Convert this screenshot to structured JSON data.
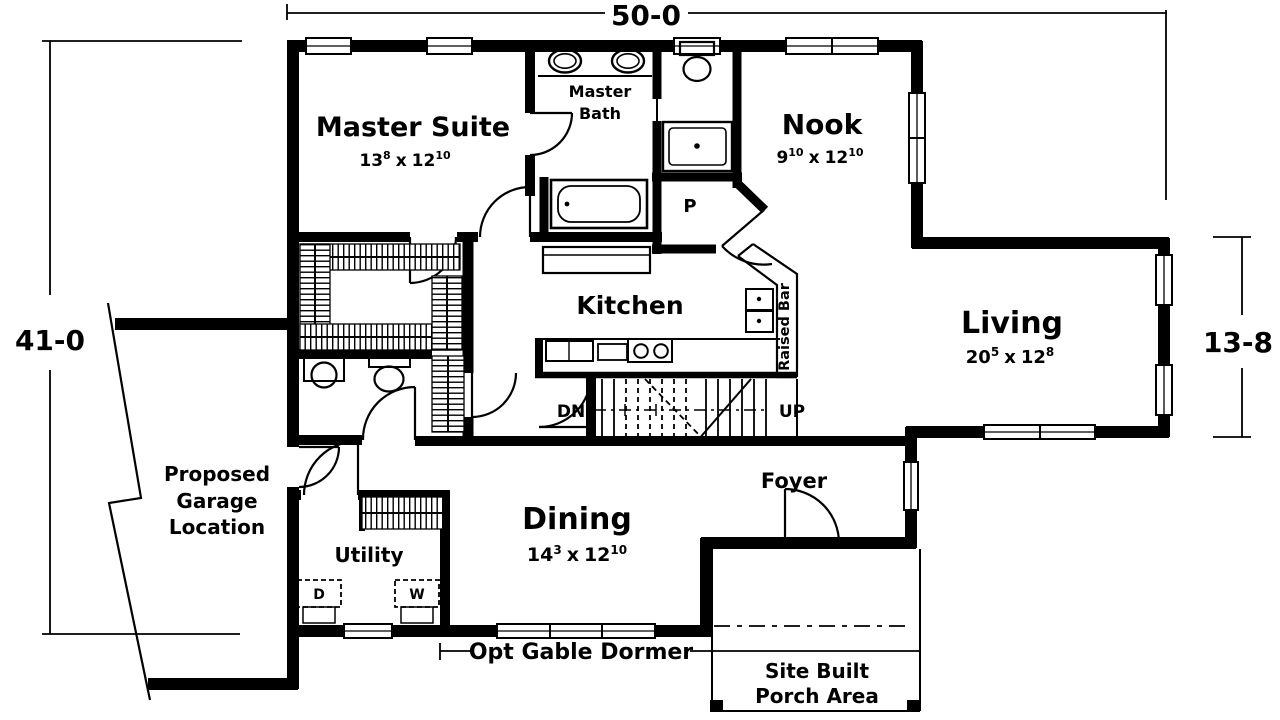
{
  "dimensions": {
    "top": "50-0",
    "left": "41-0",
    "right": "13-8"
  },
  "sep": "x",
  "rooms": {
    "master_suite": {
      "name": "Master Suite",
      "w": "13",
      "w_sup": "8",
      "h": "12",
      "h_sup": "10"
    },
    "master_bath": {
      "line1": "Master",
      "line2": "Bath"
    },
    "nook": {
      "name": "Nook",
      "w": "9",
      "w_sup": "10",
      "h": "12",
      "h_sup": "10"
    },
    "kitchen": {
      "name": "Kitchen"
    },
    "living": {
      "name": "Living",
      "w": "20",
      "w_sup": "5",
      "h": "12",
      "h_sup": "8"
    },
    "dining": {
      "name": "Dining",
      "w": "14",
      "w_sup": "3",
      "h": "12",
      "h_sup": "10"
    },
    "utility": {
      "name": "Utility"
    },
    "foyer": {
      "name": "Foyer"
    },
    "pantry": "P"
  },
  "labels": {
    "garage_line1": "Proposed",
    "garage_line2": "Garage",
    "garage_line3": "Location",
    "raised_bar": "Raised Bar",
    "stair_down": "DN",
    "stair_up": "UP",
    "dryer": "D",
    "washer": "W",
    "dormer": "Opt Gable Dormer",
    "porch_line1": "Site Built",
    "porch_line2": "Porch Area"
  },
  "colors": {
    "line": "#000000",
    "background": "#ffffff"
  }
}
